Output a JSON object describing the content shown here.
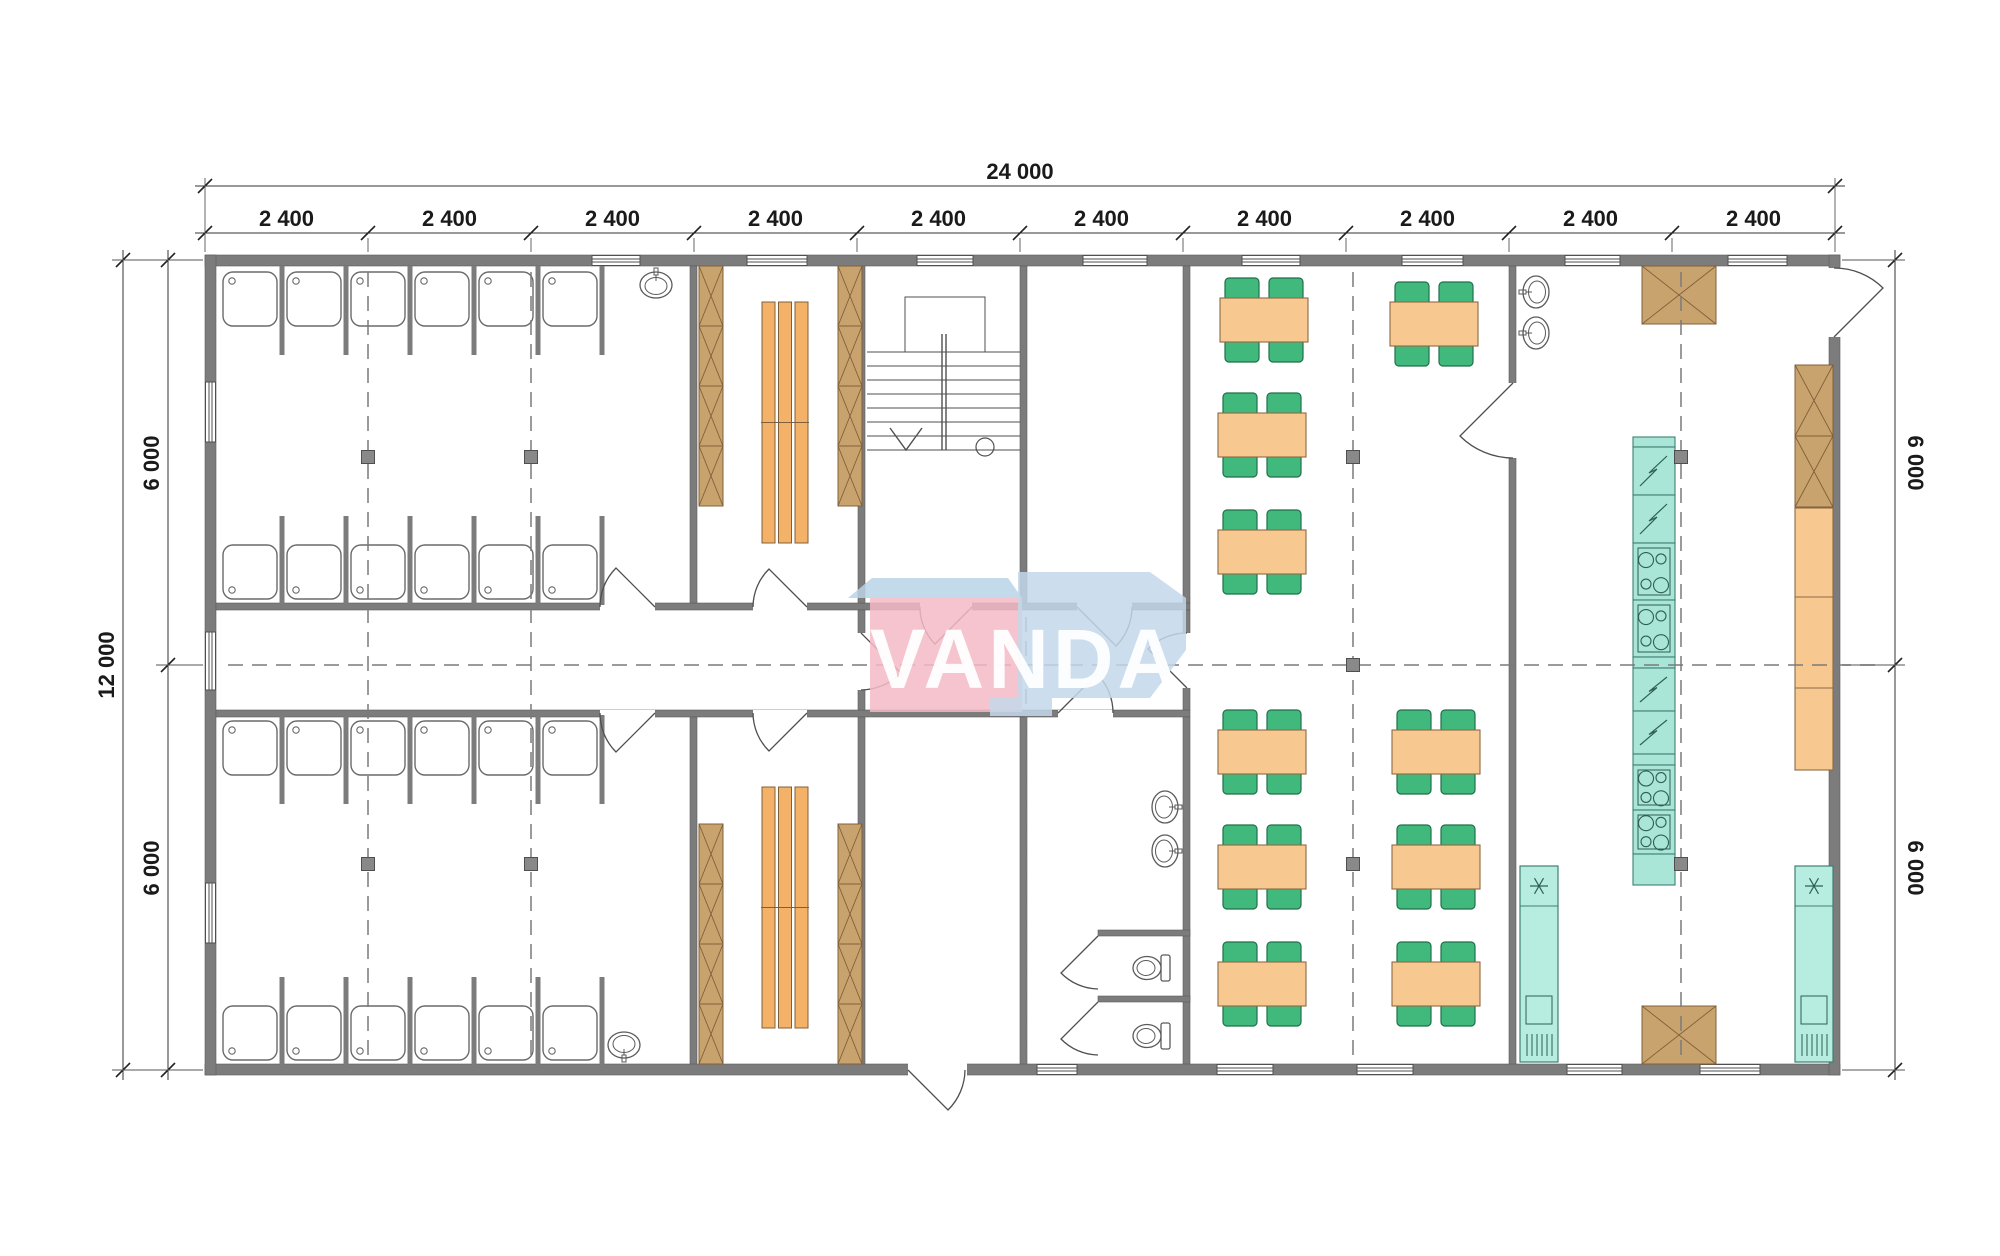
{
  "watermark": {
    "text": "VANDA",
    "pink": "#f4bac6",
    "blue": "#c3d8ea",
    "blue_top": "#b9d3e6",
    "text_color": "#ffffff"
  },
  "dimensions": {
    "top": {
      "total": "24 000",
      "segment_labels": [
        "2 400",
        "2 400",
        "2 400",
        "2 400",
        "2 400",
        "2 400",
        "2 400",
        "2 400",
        "2 400",
        "2 400"
      ]
    },
    "left": {
      "total": "12 000",
      "halves": [
        "6 000",
        "6 000"
      ]
    },
    "right": {
      "halves": [
        "6 000",
        "6 000"
      ]
    }
  },
  "colors": {
    "wall": "#7c7c7c",
    "wall_edge": "#5e5e5e",
    "line": "#4f4f4f",
    "table": "#f8c891",
    "table_edge": "#8a6a43",
    "chair": "#41b97c",
    "chair_edge": "#20704a",
    "wood": "#c9a36e",
    "wood_edge": "#80603a",
    "bench": "#f3b268",
    "teal": "#a9e6d8",
    "teal_edge": "#3f7f71",
    "column": "#898989",
    "column_edge": "#4f4f4f",
    "axis": "#7a7a7a",
    "fixture": "#5a5a5a",
    "dim_line": "#333333"
  },
  "plan": {
    "axesX": [
      205,
      368,
      531,
      694,
      857,
      1020,
      1183,
      1346,
      1509,
      1672,
      1835
    ],
    "walls": [
      [
        205,
        255,
        1635,
        11
      ],
      [
        205,
        1064,
        1635,
        11
      ],
      [
        205,
        255,
        11,
        820
      ],
      [
        1829,
        255,
        11,
        820
      ],
      [
        216,
        603,
        974,
        7
      ],
      [
        216,
        710,
        974,
        7
      ],
      [
        690,
        266,
        7,
        337
      ],
      [
        690,
        717,
        7,
        347
      ],
      [
        858,
        266,
        7,
        337
      ],
      [
        858,
        610,
        7,
        100
      ],
      [
        858,
        717,
        7,
        347
      ],
      [
        1020,
        266,
        7,
        337
      ],
      [
        1020,
        717,
        7,
        347
      ],
      [
        1183,
        266,
        7,
        337
      ],
      [
        1183,
        610,
        7,
        100
      ],
      [
        1183,
        717,
        7,
        347
      ],
      [
        1509,
        266,
        7,
        798
      ],
      [
        1098,
        930,
        92,
        6
      ],
      [
        1098,
        996,
        92,
        6
      ]
    ],
    "gaps": [
      [
        600,
        602,
        55,
        9
      ],
      [
        753,
        602,
        54,
        9
      ],
      [
        920,
        602,
        52,
        9
      ],
      [
        1077,
        602,
        55,
        9
      ],
      [
        600,
        710,
        55,
        8
      ],
      [
        753,
        710,
        54,
        8
      ],
      [
        1058,
        710,
        55,
        8
      ],
      [
        857,
        633,
        9,
        57
      ],
      [
        1182,
        633,
        9,
        55
      ],
      [
        1508,
        383,
        9,
        75
      ],
      [
        908,
        1063,
        59,
        13
      ],
      [
        1828,
        268,
        13,
        69
      ]
    ],
    "windows_h": [
      [
        592,
        255,
        48
      ],
      [
        747,
        255,
        60
      ],
      [
        917,
        255,
        56
      ],
      [
        1083,
        255,
        64
      ],
      [
        1242,
        255,
        58
      ],
      [
        1402,
        255,
        61
      ],
      [
        1565,
        255,
        55
      ],
      [
        1728,
        255,
        59
      ],
      [
        1037,
        1064,
        40
      ],
      [
        1217,
        1064,
        56
      ],
      [
        1357,
        1064,
        56
      ],
      [
        1567,
        1064,
        55
      ],
      [
        1700,
        1064,
        60
      ]
    ],
    "windows_v": [
      [
        205,
        382,
        60
      ],
      [
        205,
        632,
        58
      ],
      [
        205,
        883,
        60
      ]
    ],
    "axis_lines_v": [
      [
        368,
        272,
        1060
      ],
      [
        531,
        272,
        1060
      ],
      [
        1026,
        617,
        1060
      ],
      [
        1353,
        272,
        1060
      ],
      [
        1681,
        272,
        1060
      ]
    ],
    "axis_line_h": [
      665,
      228,
      1878
    ],
    "columns": [
      [
        368,
        457
      ],
      [
        531,
        457
      ],
      [
        368,
        864
      ],
      [
        531,
        864
      ],
      [
        1353,
        457
      ],
      [
        1353,
        665
      ],
      [
        1353,
        864
      ],
      [
        1681,
        457
      ],
      [
        1681,
        864
      ]
    ],
    "stall_rows": [
      {
        "x": 218,
        "y": 268,
        "n": 6,
        "drain": "tl",
        "stub": "down"
      },
      {
        "x": 218,
        "y": 541,
        "n": 6,
        "drain": "bl",
        "stub": "up"
      },
      {
        "x": 218,
        "y": 717,
        "n": 6,
        "drain": "tl",
        "stub": "down"
      },
      {
        "x": 218,
        "y": 1002,
        "n": 6,
        "drain": "bl",
        "stub": "up"
      }
    ],
    "tables": [
      [
        1220,
        298
      ],
      [
        1218,
        413
      ],
      [
        1218,
        530
      ],
      [
        1390,
        302
      ],
      [
        1218,
        730
      ],
      [
        1218,
        845
      ],
      [
        1218,
        962
      ],
      [
        1392,
        730
      ],
      [
        1392,
        845
      ],
      [
        1392,
        962
      ]
    ],
    "lockers": [
      {
        "x": 699,
        "y": 266,
        "w": 24,
        "ch": 60,
        "n": 4
      },
      {
        "x": 838,
        "y": 266,
        "w": 24,
        "ch": 60,
        "n": 4
      },
      {
        "x": 699,
        "y": 824,
        "w": 24,
        "ch": 60,
        "n": 4
      },
      {
        "x": 838,
        "y": 824,
        "w": 24,
        "ch": 60,
        "n": 4
      },
      {
        "x": 1795,
        "y": 365,
        "w": 38,
        "ch": 71,
        "n": 2
      },
      {
        "x": 1642,
        "y": 266,
        "w": 74,
        "ch": 58,
        "n": 1
      },
      {
        "x": 1642,
        "y": 1006,
        "w": 74,
        "ch": 58,
        "n": 1
      }
    ],
    "benches": [
      [
        762,
        302,
        241
      ],
      [
        762,
        787,
        241
      ]
    ],
    "island": {
      "x": 1633,
      "y": 437,
      "w": 42,
      "sections": [
        [
          "p",
          10
        ],
        [
          "b",
          48
        ],
        [
          "b",
          48
        ],
        [
          "s",
          57
        ],
        [
          "s",
          57
        ],
        [
          "p",
          11
        ],
        [
          "b",
          43
        ],
        [
          "b",
          43
        ],
        [
          "p",
          11
        ],
        [
          "s",
          45
        ],
        [
          "s",
          44
        ],
        [
          "p",
          31
        ]
      ]
    },
    "fridges": [
      [
        1520,
        866
      ],
      [
        1795,
        866
      ]
    ],
    "counter": {
      "x": 1795,
      "y": 508,
      "w": 38,
      "h": 262,
      "div": [
        597,
        688
      ]
    },
    "basins": [
      [
        656,
        282,
        0
      ],
      [
        624,
        1048,
        180
      ],
      [
        1533,
        292,
        -90
      ],
      [
        1533,
        333,
        -90
      ],
      [
        1168,
        807,
        90
      ],
      [
        1168,
        851,
        90
      ]
    ],
    "toilets": [
      [
        1152,
        968
      ],
      [
        1152,
        1036
      ]
    ],
    "stairs": {
      "x1": 867,
      "x2": 1020,
      "treads": [
        352,
        366,
        380,
        394,
        408,
        422,
        436,
        450
      ],
      "landing": [
        905,
        297,
        80,
        55
      ],
      "rail": [
        944,
        334,
        450
      ],
      "arrow": [
        [
          890,
          428
        ],
        [
          906,
          450
        ],
        [
          922,
          428
        ]
      ],
      "circle": [
        985,
        447,
        9
      ]
    },
    "doors": [
      "M655,607 L616,568 A55,55 0 0,0 600,607",
      "M655,713 L616,752 A55,55 0 0,1 600,713",
      "M807,607 L769,569 A54,54 0 0,0 753,607",
      "M807,713 L769,751 A54,54 0 0,1 753,713",
      "M861,633 L901,673 A57,57 0 0,1 861,690",
      "M972,607 L935,644 A52,52 0 0,1 920,607",
      "M1077,607 L1116,646 A55,55 0 0,0 1132,607",
      "M1187,688 L1148,649 A55,55 0 0,1 1187,633",
      "M1058,713 L1097,674 A55,55 0 0,1 1113,713",
      "M1098,936 L1061,973 A53,53 0 0,0 1098,989",
      "M1098,1002 L1061,1039 A53,53 0 0,0 1098,1055",
      "M908,1070 L948,1110 A57,57 0 0,0 965,1070",
      "M1513,383 L1460,436 A75,75 0 0,0 1513,458",
      "M1834,337 L1883,288 A69,69 0 0,0 1834,268"
    ]
  }
}
